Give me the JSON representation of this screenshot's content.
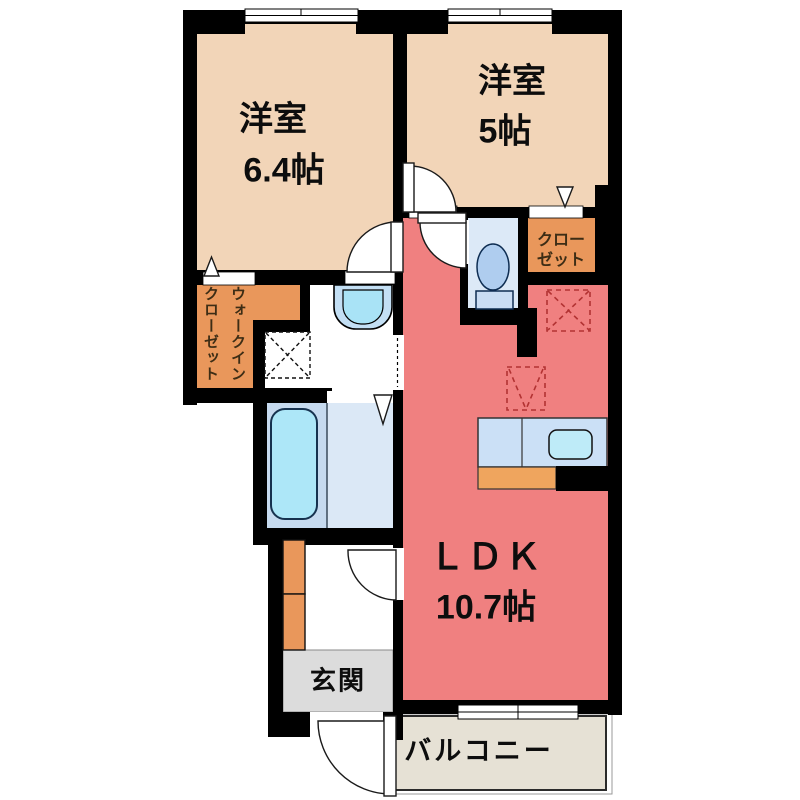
{
  "plan_title": "1LDK apartment floor plan",
  "rooms": {
    "bedroom1": {
      "name": "洋室",
      "size": "6.4帖"
    },
    "bedroom2": {
      "name": "洋室",
      "size": "5帖"
    },
    "ldk": {
      "name": "ＬＤＫ",
      "size": "10.7帖"
    },
    "wic": {
      "label": "ウォークインクローゼット"
    },
    "closet": {
      "label_line1": "クロー",
      "label_line2": "ゼット"
    },
    "entrance": {
      "label": "玄関"
    },
    "balcony": {
      "label": "バルコニー"
    }
  },
  "fixtures": [
    "bathtub",
    "toilet",
    "washbasin",
    "kitchen-sink",
    "washing-machine-space",
    "refrigerator-space",
    "shoe-cabinet"
  ],
  "palette": {
    "wall": "#000000",
    "bedroom_peach": "#F2D5B8",
    "ldk_salmon": "#F08080",
    "closet_orange": "#E9975B",
    "kitchen_cabinet_orange": "#EFA55E",
    "bathroom_panel_blue": "#C6DAEF",
    "bathroom_floor_blue": "#DBE8F6",
    "bathtub_cyan": "#ADE7F8",
    "toilet_room_blue": "#DCE9F7",
    "fixture_blue": "#AFCDEF",
    "counter_blue": "#CBE0F6",
    "sink_cyan": "#BEEBF8",
    "entrance_gray": "#DCDCDC",
    "balcony_beige": "#E6E1D5",
    "appliance_marker_red": "#B23232",
    "label_brown": "#3D2D15"
  }
}
